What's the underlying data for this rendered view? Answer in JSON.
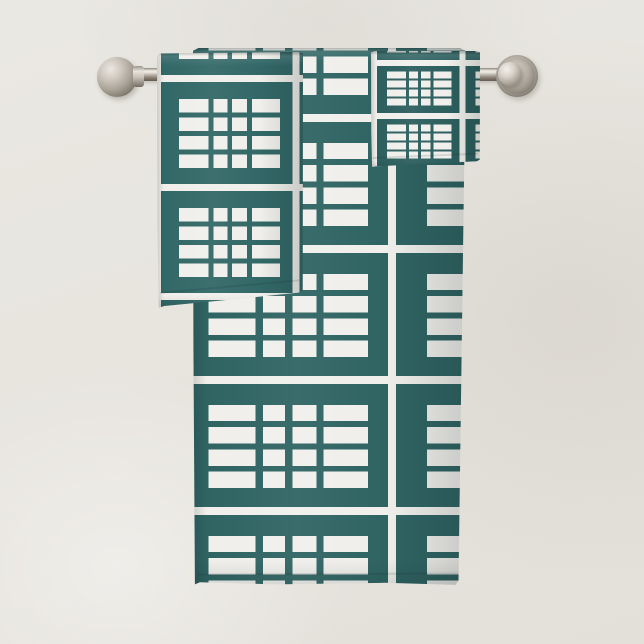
{
  "scene": {
    "type": "product-photo",
    "description": "Teal green and white modern windowpane plaid bath towel set - bath towel, hand towel and washcloth folded over a brushed nickel wall-mounted towel bar against a light neutral wall",
    "canvas": {
      "width": 644,
      "height": 644
    }
  },
  "colors": {
    "wall_base": "#eae8e2",
    "wall_mid": "#e7e4de",
    "wall_shade": "#e3e0d9",
    "pattern_white": "#f0efeb",
    "teal_bath": "#2f6463",
    "teal_hand": "#326867",
    "teal_wash": "#2c5f5e",
    "metal_light": "#d6d1c8",
    "metal_mid": "#a8a197",
    "metal_dark": "#6e6860"
  },
  "towel_bar": {
    "rod": {
      "x": 119,
      "y": 68,
      "width": 399,
      "height": 13
    },
    "left_finial": {
      "cx": 117,
      "cy": 77,
      "r": 20
    },
    "left_collar": {
      "x": 133,
      "y": 66,
      "width": 11,
      "height": 21
    },
    "right_plate": {
      "cx": 517,
      "cy": 76,
      "r": 21
    },
    "right_ball": {
      "cx": 510,
      "cy": 74,
      "r": 12
    }
  },
  "pattern": {
    "tile_aspect": 1.67,
    "block": {
      "x0": 0.3,
      "cols": [
        0.36,
        0.17,
        0.18,
        0.34
      ],
      "col_gap": 0.057,
      "y0": 0.22,
      "rows": 4,
      "row_h": 0.125,
      "row_gap": 0.045
    }
  },
  "towels": [
    {
      "id": "bath-towel",
      "label": "bath towel",
      "x": 193,
      "y": 48,
      "w": 274,
      "h": 538,
      "tile_h": 131,
      "h_scale": 1.0,
      "origin_x": -24,
      "origin_y": 66,
      "stripe_px": 8,
      "teal_key": "teal_bath",
      "z": 4
    },
    {
      "id": "washcloth",
      "label": "washcloth",
      "x": 371,
      "y": 51,
      "w": 109,
      "h": 116,
      "tile_h": 53,
      "h_scale": 1.0,
      "origin_x": 0,
      "origin_y": 9,
      "stripe_px": 6,
      "teal_key": "teal_wash",
      "z": 5
    },
    {
      "id": "hand-towel",
      "label": "hand towel",
      "x": 157,
      "y": 52,
      "w": 146,
      "h": 256,
      "tile_h": 109,
      "h_scale": 0.76,
      "origin_x": -3,
      "origin_y": 23,
      "stripe_px": 7,
      "teal_key": "teal_hand",
      "z": 6
    }
  ]
}
